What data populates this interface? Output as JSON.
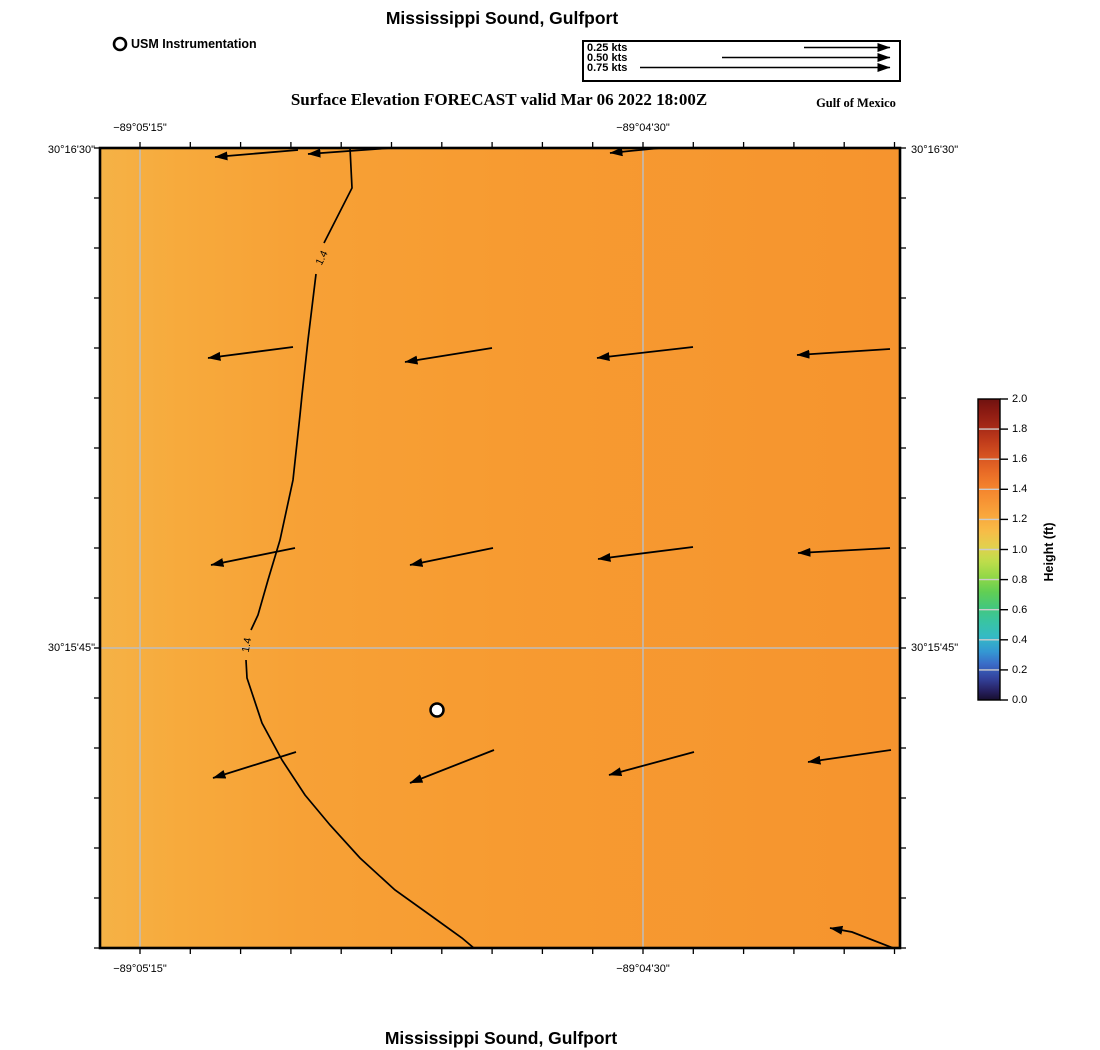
{
  "header": {
    "title": "Mississippi Sound, Gulfport",
    "station_legend_label": "USM Instrumentation",
    "subtitle": "Surface Elevation FORECAST valid Mar 06 2022 18:00Z",
    "region_label": "Gulf of Mexico"
  },
  "footer": {
    "title": "Mississippi Sound, Gulfport"
  },
  "speed_legend": {
    "box": {
      "x": 582,
      "y": 40,
      "w": 315,
      "h": 38
    },
    "tip_x": 891,
    "row_y": [
      48,
      58,
      68
    ],
    "items": [
      {
        "label": "0.25 kts",
        "tail_x": 804
      },
      {
        "label": "0.50 kts",
        "tail_x": 722
      },
      {
        "label": "0.75 kts",
        "tail_x": 640
      }
    ]
  },
  "chart_data": {
    "type": "heatmap",
    "title": "Mississippi Sound, Gulfport",
    "subtitle": "Surface Elevation FORECAST valid Mar 06 2022 18:00Z",
    "field": "Surface elevation (ft) with current vectors",
    "region_label": "Gulf of Mexico",
    "map_area": {
      "x": 100,
      "y": 148,
      "w": 800,
      "h": 800
    },
    "fill_gradient": [
      [
        "0",
        "#f5b246"
      ],
      [
        "0.10",
        "#f7aa3c"
      ],
      [
        "0.25",
        "#f7a136"
      ],
      [
        "0.50",
        "#f79b31"
      ],
      [
        "1",
        "#f6942e"
      ]
    ],
    "grid_color": "#bdbdbd",
    "x_axis": {
      "ticks": {
        "start": 140,
        "step": 50.3,
        "count": 16
      },
      "gridlines": [
        140,
        643
      ],
      "labels": [
        {
          "text": "−89°05'15\"",
          "x": 140
        },
        {
          "text": "−89°04'30\"",
          "x": 643
        }
      ],
      "top_label_y": 128,
      "bottom_label_y": 969
    },
    "y_axis": {
      "ticks": {
        "start": 148,
        "step": 50,
        "count": 17
      },
      "gridlines": [
        648
      ],
      "labels": [
        {
          "text": "30°16'30\"",
          "y": 150
        },
        {
          "text": "30°15'45\"",
          "y": 648
        }
      ],
      "left_label_x": 95,
      "right_label_x": 911
    },
    "contour": {
      "level": "1.4",
      "color": "#000000",
      "segments": [
        [
          [
            350,
            148
          ],
          [
            352,
            188
          ],
          [
            324,
            243
          ]
        ],
        [
          [
            316,
            274
          ],
          [
            308,
            340
          ],
          [
            302,
            395
          ],
          [
            300,
            415
          ],
          [
            293,
            480
          ],
          [
            280,
            540
          ],
          [
            268,
            580
          ],
          [
            258,
            615
          ],
          [
            251,
            630
          ]
        ],
        [
          [
            246,
            660
          ],
          [
            247,
            678
          ],
          [
            252,
            693
          ],
          [
            262,
            723
          ],
          [
            282,
            760
          ],
          [
            305,
            795
          ],
          [
            330,
            825
          ],
          [
            360,
            858
          ],
          [
            395,
            890
          ],
          [
            430,
            915
          ],
          [
            462,
            938
          ],
          [
            475,
            949
          ]
        ]
      ],
      "labels": [
        {
          "x": 322,
          "y": 258,
          "rot": -64
        },
        {
          "x": 247,
          "y": 645,
          "rot": -80
        }
      ]
    },
    "vectors": {
      "color": "#000000",
      "list": [
        [
          [
            298,
            150
          ],
          [
            215,
            157
          ]
        ],
        [
          [
            390,
            148
          ],
          [
            308,
            154
          ]
        ],
        [
          [
            680,
            146
          ],
          [
            610,
            153
          ]
        ],
        [
          [
            293,
            347
          ],
          [
            208,
            358
          ]
        ],
        [
          [
            492,
            348
          ],
          [
            405,
            362
          ]
        ],
        [
          [
            693,
            347
          ],
          [
            597,
            358
          ]
        ],
        [
          [
            890,
            349
          ],
          [
            797,
            355
          ]
        ],
        [
          [
            295,
            548
          ],
          [
            211,
            565
          ]
        ],
        [
          [
            493,
            548
          ],
          [
            410,
            565
          ]
        ],
        [
          [
            693,
            547
          ],
          [
            598,
            559
          ]
        ],
        [
          [
            890,
            548
          ],
          [
            798,
            553
          ]
        ],
        [
          [
            296,
            752
          ],
          [
            213,
            778
          ]
        ],
        [
          [
            494,
            750
          ],
          [
            410,
            783
          ]
        ],
        [
          [
            694,
            752
          ],
          [
            609,
            775
          ]
        ],
        [
          [
            891,
            750
          ],
          [
            808,
            762
          ]
        ],
        [
          [
            893,
            948
          ],
          [
            852,
            932
          ],
          [
            830,
            928
          ]
        ]
      ]
    },
    "station": {
      "x": 437,
      "y": 710,
      "r": 6.5,
      "label": "USM Instrumentation"
    },
    "legend_marker": {
      "x": 120,
      "y": 44,
      "r": 6
    },
    "colorbar": {
      "x": 978,
      "y": 399,
      "w": 22,
      "h": 301,
      "label": "Height (ft)",
      "min": 0.0,
      "max": 2.0,
      "tick_labels": [
        "2.0",
        "1.8",
        "1.6",
        "1.4",
        "1.2",
        "1.0",
        "0.8",
        "0.6",
        "0.4",
        "0.2",
        "0.0"
      ],
      "divider_color": "#cccccc",
      "gradient": [
        [
          "0",
          "#6f1210"
        ],
        [
          "0.04",
          "#8a1a12"
        ],
        [
          "0.09",
          "#a42817"
        ],
        [
          "0.14",
          "#c03c1b"
        ],
        [
          "0.19",
          "#d65321"
        ],
        [
          "0.24",
          "#e86a26"
        ],
        [
          "0.29",
          "#f3812c"
        ],
        [
          "0.34",
          "#f79434"
        ],
        [
          "0.39",
          "#f9a83d"
        ],
        [
          "0.44",
          "#f7bc47"
        ],
        [
          "0.49",
          "#e2d04d"
        ],
        [
          "0.54",
          "#bedd4b"
        ],
        [
          "0.59",
          "#93d847"
        ],
        [
          "0.64",
          "#62cf53"
        ],
        [
          "0.69",
          "#45c87b"
        ],
        [
          "0.74",
          "#38c4a3"
        ],
        [
          "0.79",
          "#35bac5"
        ],
        [
          "0.84",
          "#3497d3"
        ],
        [
          "0.88",
          "#3a6cc8"
        ],
        [
          "0.93",
          "#33419a"
        ],
        [
          "0.97",
          "#262060"
        ],
        [
          "1",
          "#170e2e"
        ]
      ],
      "label_x": 1049,
      "label_y": 552,
      "tick_label_x": 1012
    }
  }
}
